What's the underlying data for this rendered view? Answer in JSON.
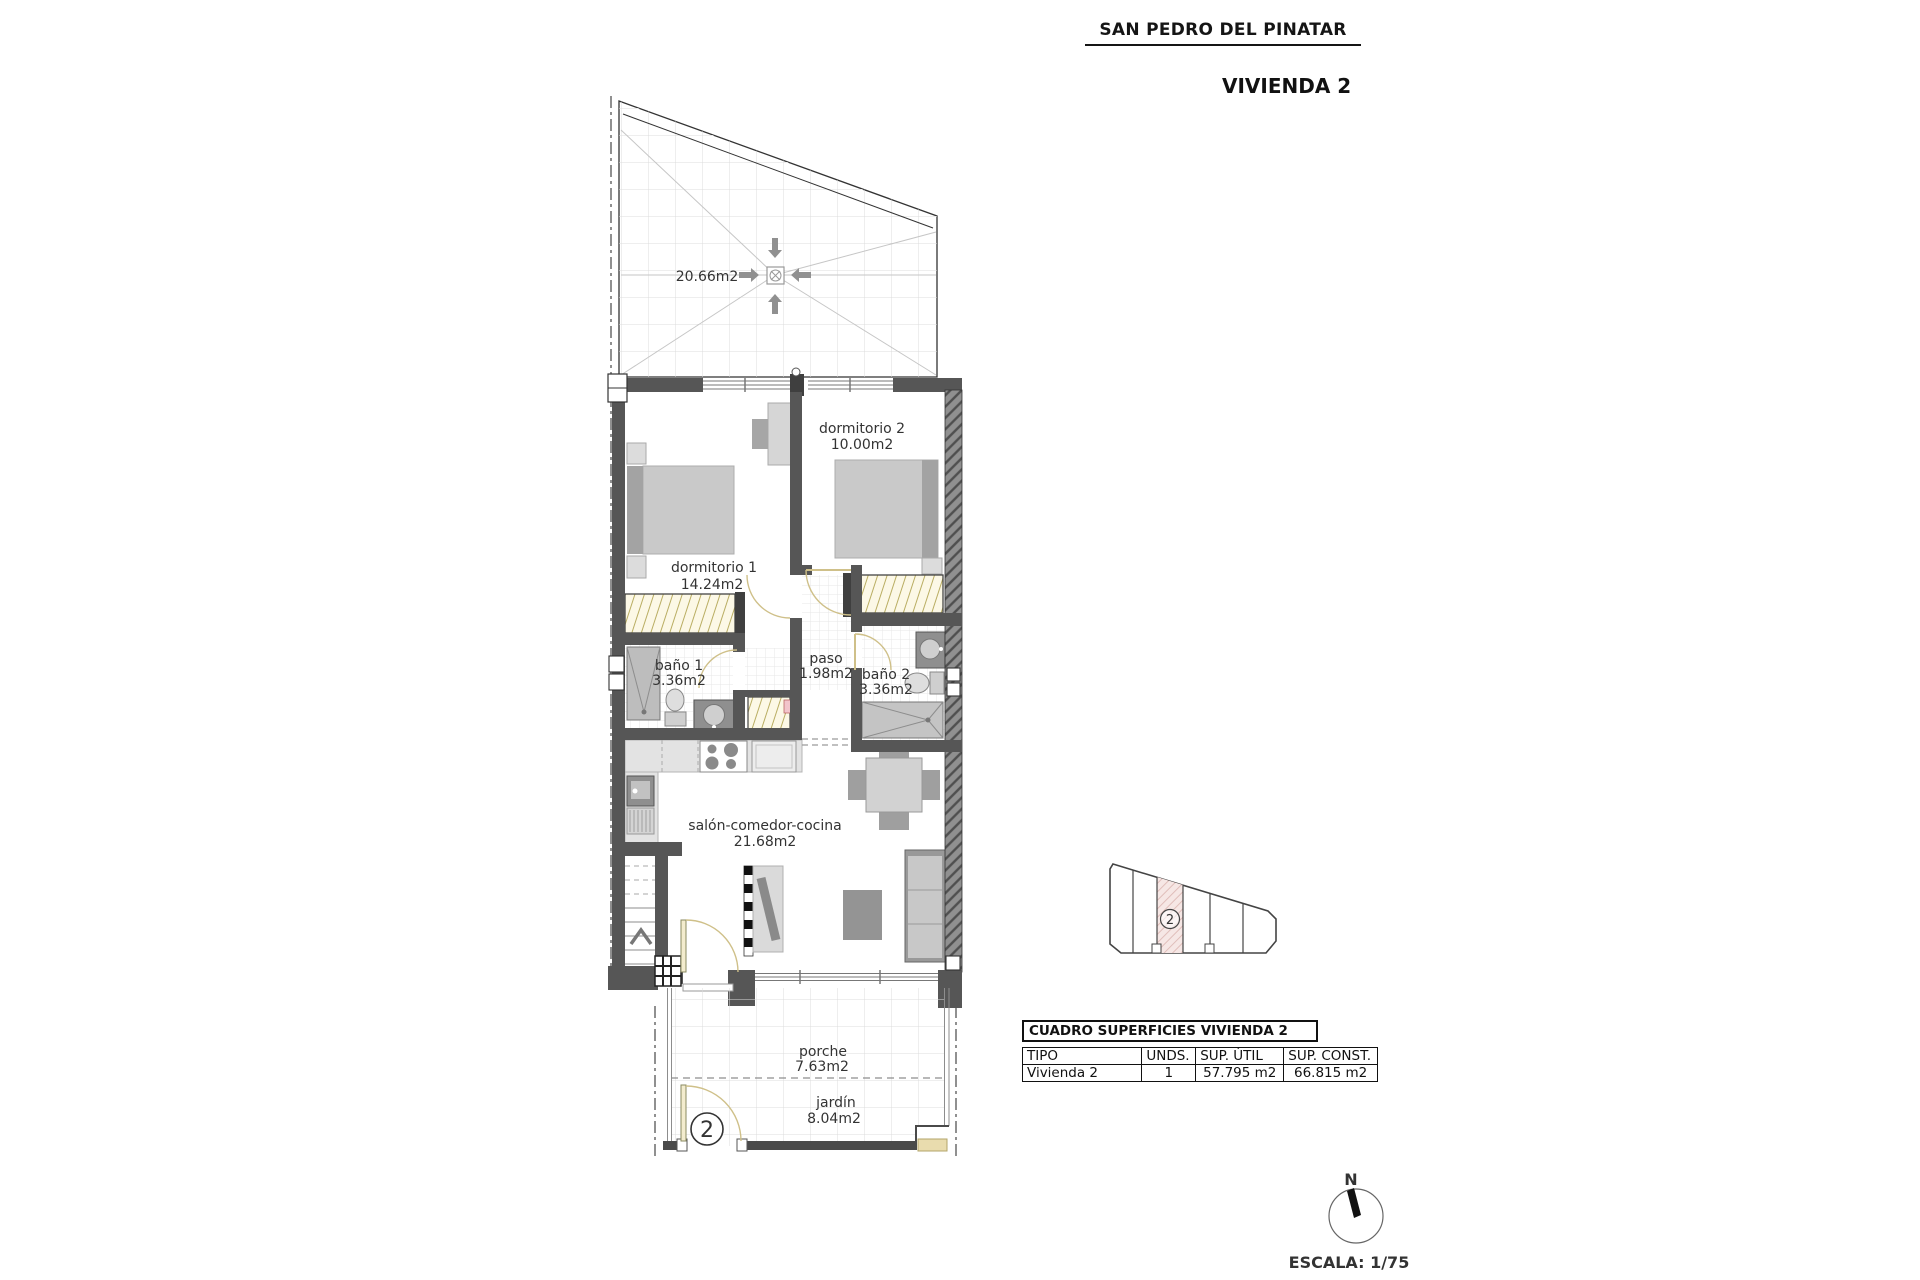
{
  "header": {
    "location": "SAN PEDRO DEL PINATAR",
    "title": "VIVIENDA 2"
  },
  "floor_plan": {
    "roof_terrace": {
      "area": "20.66m2"
    },
    "rooms": [
      {
        "name": "dormitorio 2",
        "area": "10.00m2"
      },
      {
        "name": "dormitorio 1",
        "area": "14.24m2"
      },
      {
        "name": "baño 1",
        "area": "3.36m2"
      },
      {
        "name": "paso",
        "area": "1.98m2"
      },
      {
        "name": "baño 2",
        "area": "3.36m2"
      },
      {
        "name": "salón-comedor-cocina",
        "area": "21.68m2"
      },
      {
        "name": "porche",
        "area": "7.63m2"
      },
      {
        "name": "jardín",
        "area": "8.04m2"
      }
    ],
    "unit_number": "2"
  },
  "site_plan": {
    "highlighted_unit": "2"
  },
  "surface_table": {
    "title": "CUADRO SUPERFICIES VIVIENDA 2",
    "columns": [
      "TIPO",
      "UNDS.",
      "SUP. ÚTIL",
      "SUP. CONST."
    ],
    "rows": [
      {
        "tipo": "Vivienda 2",
        "unds": "1",
        "sup_util": "57.795 m2",
        "sup_const": "66.815 m2"
      }
    ]
  },
  "compass": {
    "north_label": "N"
  },
  "scale_label": "ESCALA: 1/75"
}
